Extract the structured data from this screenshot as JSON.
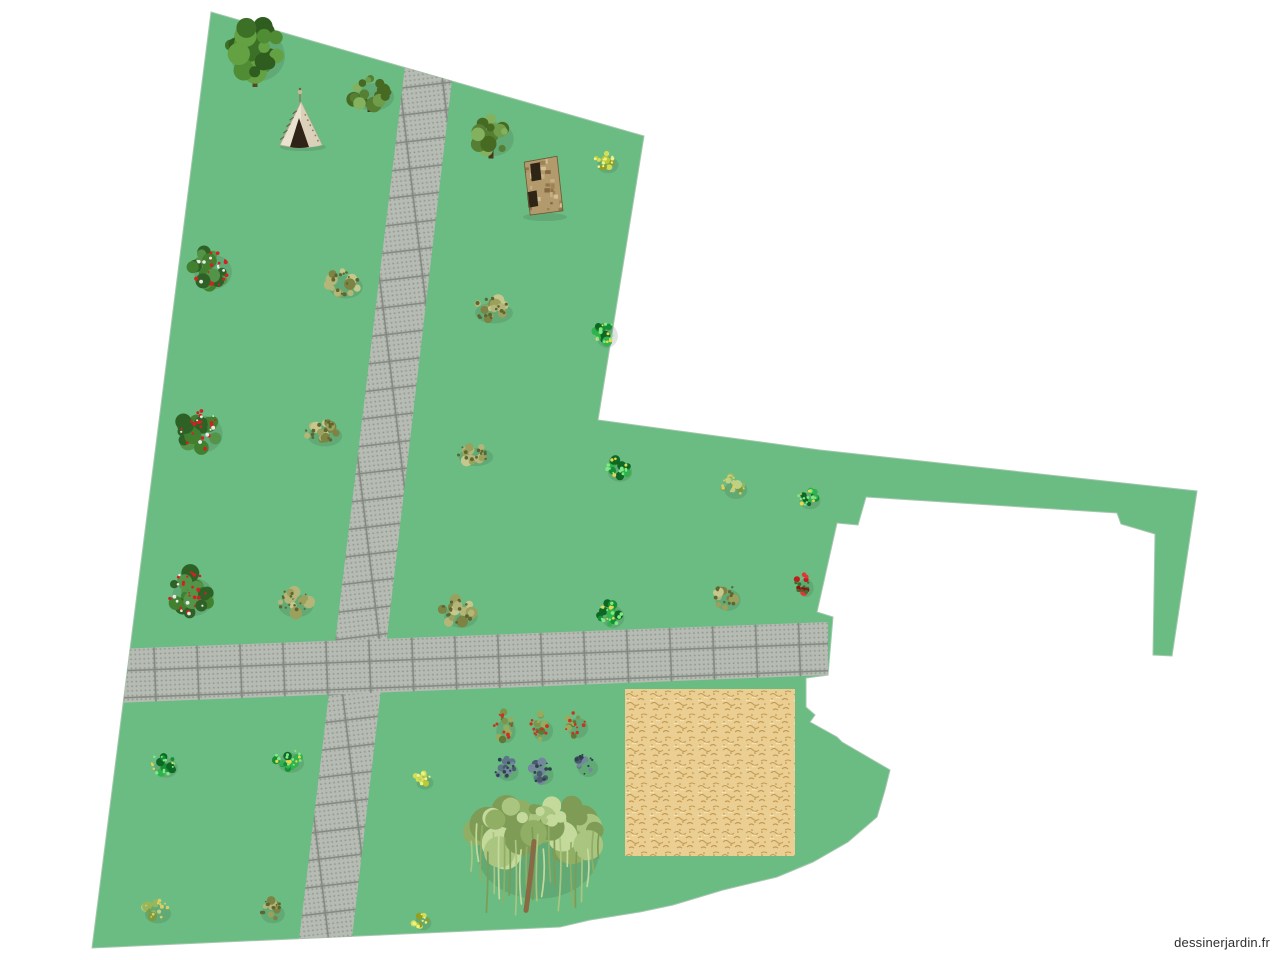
{
  "app": {
    "watermark": "dessinerjardin.fr",
    "watermark_color": "#2e2e2e"
  },
  "canvas": {
    "width": 1280,
    "height": 960,
    "background": "#ffffff"
  },
  "colors": {
    "grass": "#6abc82",
    "plot_edge": "#a3c7ad",
    "tile_base": "#b6bbb4",
    "tile_grout": "#82887f",
    "tile_dot": "#9da49b",
    "sand_base": "#ebcf92",
    "sand_stroke": "#c49a55",
    "sand_dark": "#93702f",
    "sand_light": "#f7e7ba"
  },
  "plot": {
    "outline": [
      [
        211,
        12
      ],
      [
        644,
        136
      ],
      [
        598,
        420
      ],
      [
        820,
        450
      ],
      [
        1197,
        491
      ],
      [
        1172,
        656
      ],
      [
        1153,
        655
      ],
      [
        1155,
        534
      ],
      [
        1121,
        524
      ],
      [
        1117,
        513
      ],
      [
        866,
        497
      ],
      [
        858,
        525
      ],
      [
        837,
        523
      ],
      [
        817,
        612
      ],
      [
        833,
        617
      ],
      [
        828,
        675
      ],
      [
        806,
        678
      ],
      [
        806,
        707
      ],
      [
        815,
        715
      ],
      [
        810,
        722
      ],
      [
        837,
        737
      ],
      [
        842,
        742
      ],
      [
        890,
        770
      ],
      [
        885,
        790
      ],
      [
        877,
        817
      ],
      [
        848,
        842
      ],
      [
        813,
        862
      ],
      [
        777,
        877
      ],
      [
        723,
        890
      ],
      [
        673,
        905
      ],
      [
        640,
        912
      ],
      [
        590,
        920
      ],
      [
        560,
        927
      ],
      [
        92,
        948
      ]
    ]
  },
  "walkways": [
    {
      "name": "vertical-path",
      "orientation": "vertical",
      "points": [
        [
          405,
          66
        ],
        [
          452,
          80
        ],
        [
          352,
          938
        ],
        [
          299,
          940
        ]
      ]
    },
    {
      "name": "horizontal-path",
      "orientation": "horizontal",
      "points": [
        [
          115,
          649
        ],
        [
          828,
          622
        ],
        [
          828,
          675
        ],
        [
          115,
          703
        ]
      ]
    }
  ],
  "sand_area": {
    "x": 625,
    "y": 689,
    "width": 170,
    "height": 167
  },
  "structures": [
    {
      "type": "teepee",
      "x": 280,
      "y": 98,
      "width": 42,
      "height": 49
    },
    {
      "type": "stone-tower",
      "x": 523,
      "y": 155,
      "width": 40,
      "height": 60
    }
  ],
  "structure_palettes": {
    "teepee": {
      "body": "#eae1cf",
      "shade": "#d8cdb6",
      "door": "#2e2316",
      "pole": "#8a7a5a",
      "knob": "#c9b998",
      "ticks": "#6e614a"
    },
    "stone-tower": {
      "body": "#b29a6c",
      "mottle": [
        "#c9b388",
        "#9a7f52",
        "#8a6e45",
        "#d7c59b",
        "#7a5f3a"
      ],
      "opening": "#2f2517",
      "outline": "#6e5636"
    }
  },
  "plant_palettes": {
    "large-tree": {
      "body": [
        "#4f8c34",
        "#3b7026",
        "#63a143",
        "#2f5c1f"
      ],
      "trunk": "#5f4426"
    },
    "round-tree": {
      "body": [
        "#6f9d49",
        "#567f33",
        "#83b15d",
        "#466a22"
      ],
      "trunk": "#4a3520"
    },
    "olive-bush": {
      "body": [
        "#9ba05c",
        "#b3b678",
        "#7d8443",
        "#c6c78d"
      ],
      "specks": "#5e6530"
    },
    "red-flower-bush": {
      "body": [
        "#41802f",
        "#2e6126",
        "#549448"
      ],
      "specks": "#d02222",
      "specks2": "#e9e9e9"
    },
    "dark-green-bush": {
      "body": [
        "#179035",
        "#0d6824",
        "#31b24d"
      ],
      "specks": "#80e986",
      "specks2": "#e8d64c"
    },
    "yellow-bush": {
      "body": [
        "#bac934",
        "#d4dd57",
        "#939f23"
      ],
      "specks": "#ecf28c"
    },
    "berry-bush": {
      "body": [
        "#7e9449",
        "#97ab5f",
        "#607736"
      ],
      "specks": "#c53621"
    },
    "blue-bush": {
      "body": [
        "#5e7589",
        "#73889c",
        "#495a6c"
      ],
      "specks": "#303f4d"
    },
    "sparse-bush": {
      "body": [
        "#98b75b",
        "#bdd085",
        "#7b9b43"
      ],
      "specks": "#dace64"
    },
    "red-bush": {
      "body": [
        "#c11d1d",
        "#e33535",
        "#8d1313"
      ],
      "specks": "#3b6f2b"
    },
    "willow": {
      "body": [
        "#aac580",
        "#c4da9c",
        "#90af65",
        "#7e9c56"
      ],
      "trunk": "#8a6a44"
    }
  },
  "plants": [
    {
      "type": "large-tree",
      "x": 255,
      "y": 52,
      "w": 64,
      "h": 70
    },
    {
      "type": "round-tree",
      "x": 370,
      "y": 93,
      "w": 50,
      "h": 38
    },
    {
      "type": "round-tree",
      "x": 491,
      "y": 135,
      "w": 47,
      "h": 47
    },
    {
      "type": "yellow-bush",
      "x": 605,
      "y": 161,
      "w": 25,
      "h": 23
    },
    {
      "type": "red-flower-bush",
      "x": 210,
      "y": 268,
      "w": 45,
      "h": 48
    },
    {
      "type": "olive-bush",
      "x": 343,
      "y": 283,
      "w": 40,
      "h": 32
    },
    {
      "type": "olive-bush",
      "x": 491,
      "y": 309,
      "w": 45,
      "h": 29
    },
    {
      "type": "dark-green-bush",
      "x": 604,
      "y": 332,
      "w": 26,
      "h": 33
    },
    {
      "type": "red-flower-bush",
      "x": 200,
      "y": 430,
      "w": 47,
      "h": 51
    },
    {
      "type": "olive-bush",
      "x": 322,
      "y": 432,
      "w": 41,
      "h": 29
    },
    {
      "type": "olive-bush",
      "x": 473,
      "y": 453,
      "w": 41,
      "h": 25
    },
    {
      "type": "dark-green-bush",
      "x": 617,
      "y": 468,
      "w": 29,
      "h": 27
    },
    {
      "type": "sparse-bush",
      "x": 733,
      "y": 486,
      "w": 27,
      "h": 25
    },
    {
      "type": "dark-green-bush",
      "x": 807,
      "y": 497,
      "w": 25,
      "h": 23
    },
    {
      "type": "red-flower-bush",
      "x": 190,
      "y": 593,
      "w": 50,
      "h": 53
    },
    {
      "type": "olive-bush",
      "x": 293,
      "y": 602,
      "w": 41,
      "h": 31
    },
    {
      "type": "olive-bush",
      "x": 458,
      "y": 612,
      "w": 40,
      "h": 33
    },
    {
      "type": "dark-green-bush",
      "x": 610,
      "y": 613,
      "w": 27,
      "h": 31
    },
    {
      "type": "olive-bush",
      "x": 725,
      "y": 596,
      "w": 30,
      "h": 30
    },
    {
      "type": "red-bush",
      "x": 803,
      "y": 584,
      "w": 18,
      "h": 25
    },
    {
      "type": "dark-green-bush",
      "x": 163,
      "y": 764,
      "w": 28,
      "h": 27
    },
    {
      "type": "dark-green-bush",
      "x": 288,
      "y": 759,
      "w": 31,
      "h": 27
    },
    {
      "type": "yellow-bush",
      "x": 422,
      "y": 779,
      "w": 20,
      "h": 18
    },
    {
      "type": "berry-bush",
      "x": 503,
      "y": 727,
      "w": 23,
      "h": 33
    },
    {
      "type": "berry-bush",
      "x": 540,
      "y": 727,
      "w": 24,
      "h": 29
    },
    {
      "type": "berry-bush",
      "x": 575,
      "y": 724,
      "w": 24,
      "h": 28
    },
    {
      "type": "blue-bush",
      "x": 505,
      "y": 768,
      "w": 25,
      "h": 25
    },
    {
      "type": "blue-bush",
      "x": 540,
      "y": 771,
      "w": 25,
      "h": 27
    },
    {
      "type": "blue-bush",
      "x": 585,
      "y": 764,
      "w": 24,
      "h": 25
    },
    {
      "type": "willow",
      "x": 535,
      "y": 848,
      "w": 145,
      "h": 130
    },
    {
      "type": "yellow-bush",
      "x": 420,
      "y": 919,
      "w": 20,
      "h": 20
    },
    {
      "type": "sparse-bush",
      "x": 155,
      "y": 910,
      "w": 31,
      "h": 26
    },
    {
      "type": "olive-bush",
      "x": 270,
      "y": 910,
      "w": 28,
      "h": 26
    }
  ]
}
